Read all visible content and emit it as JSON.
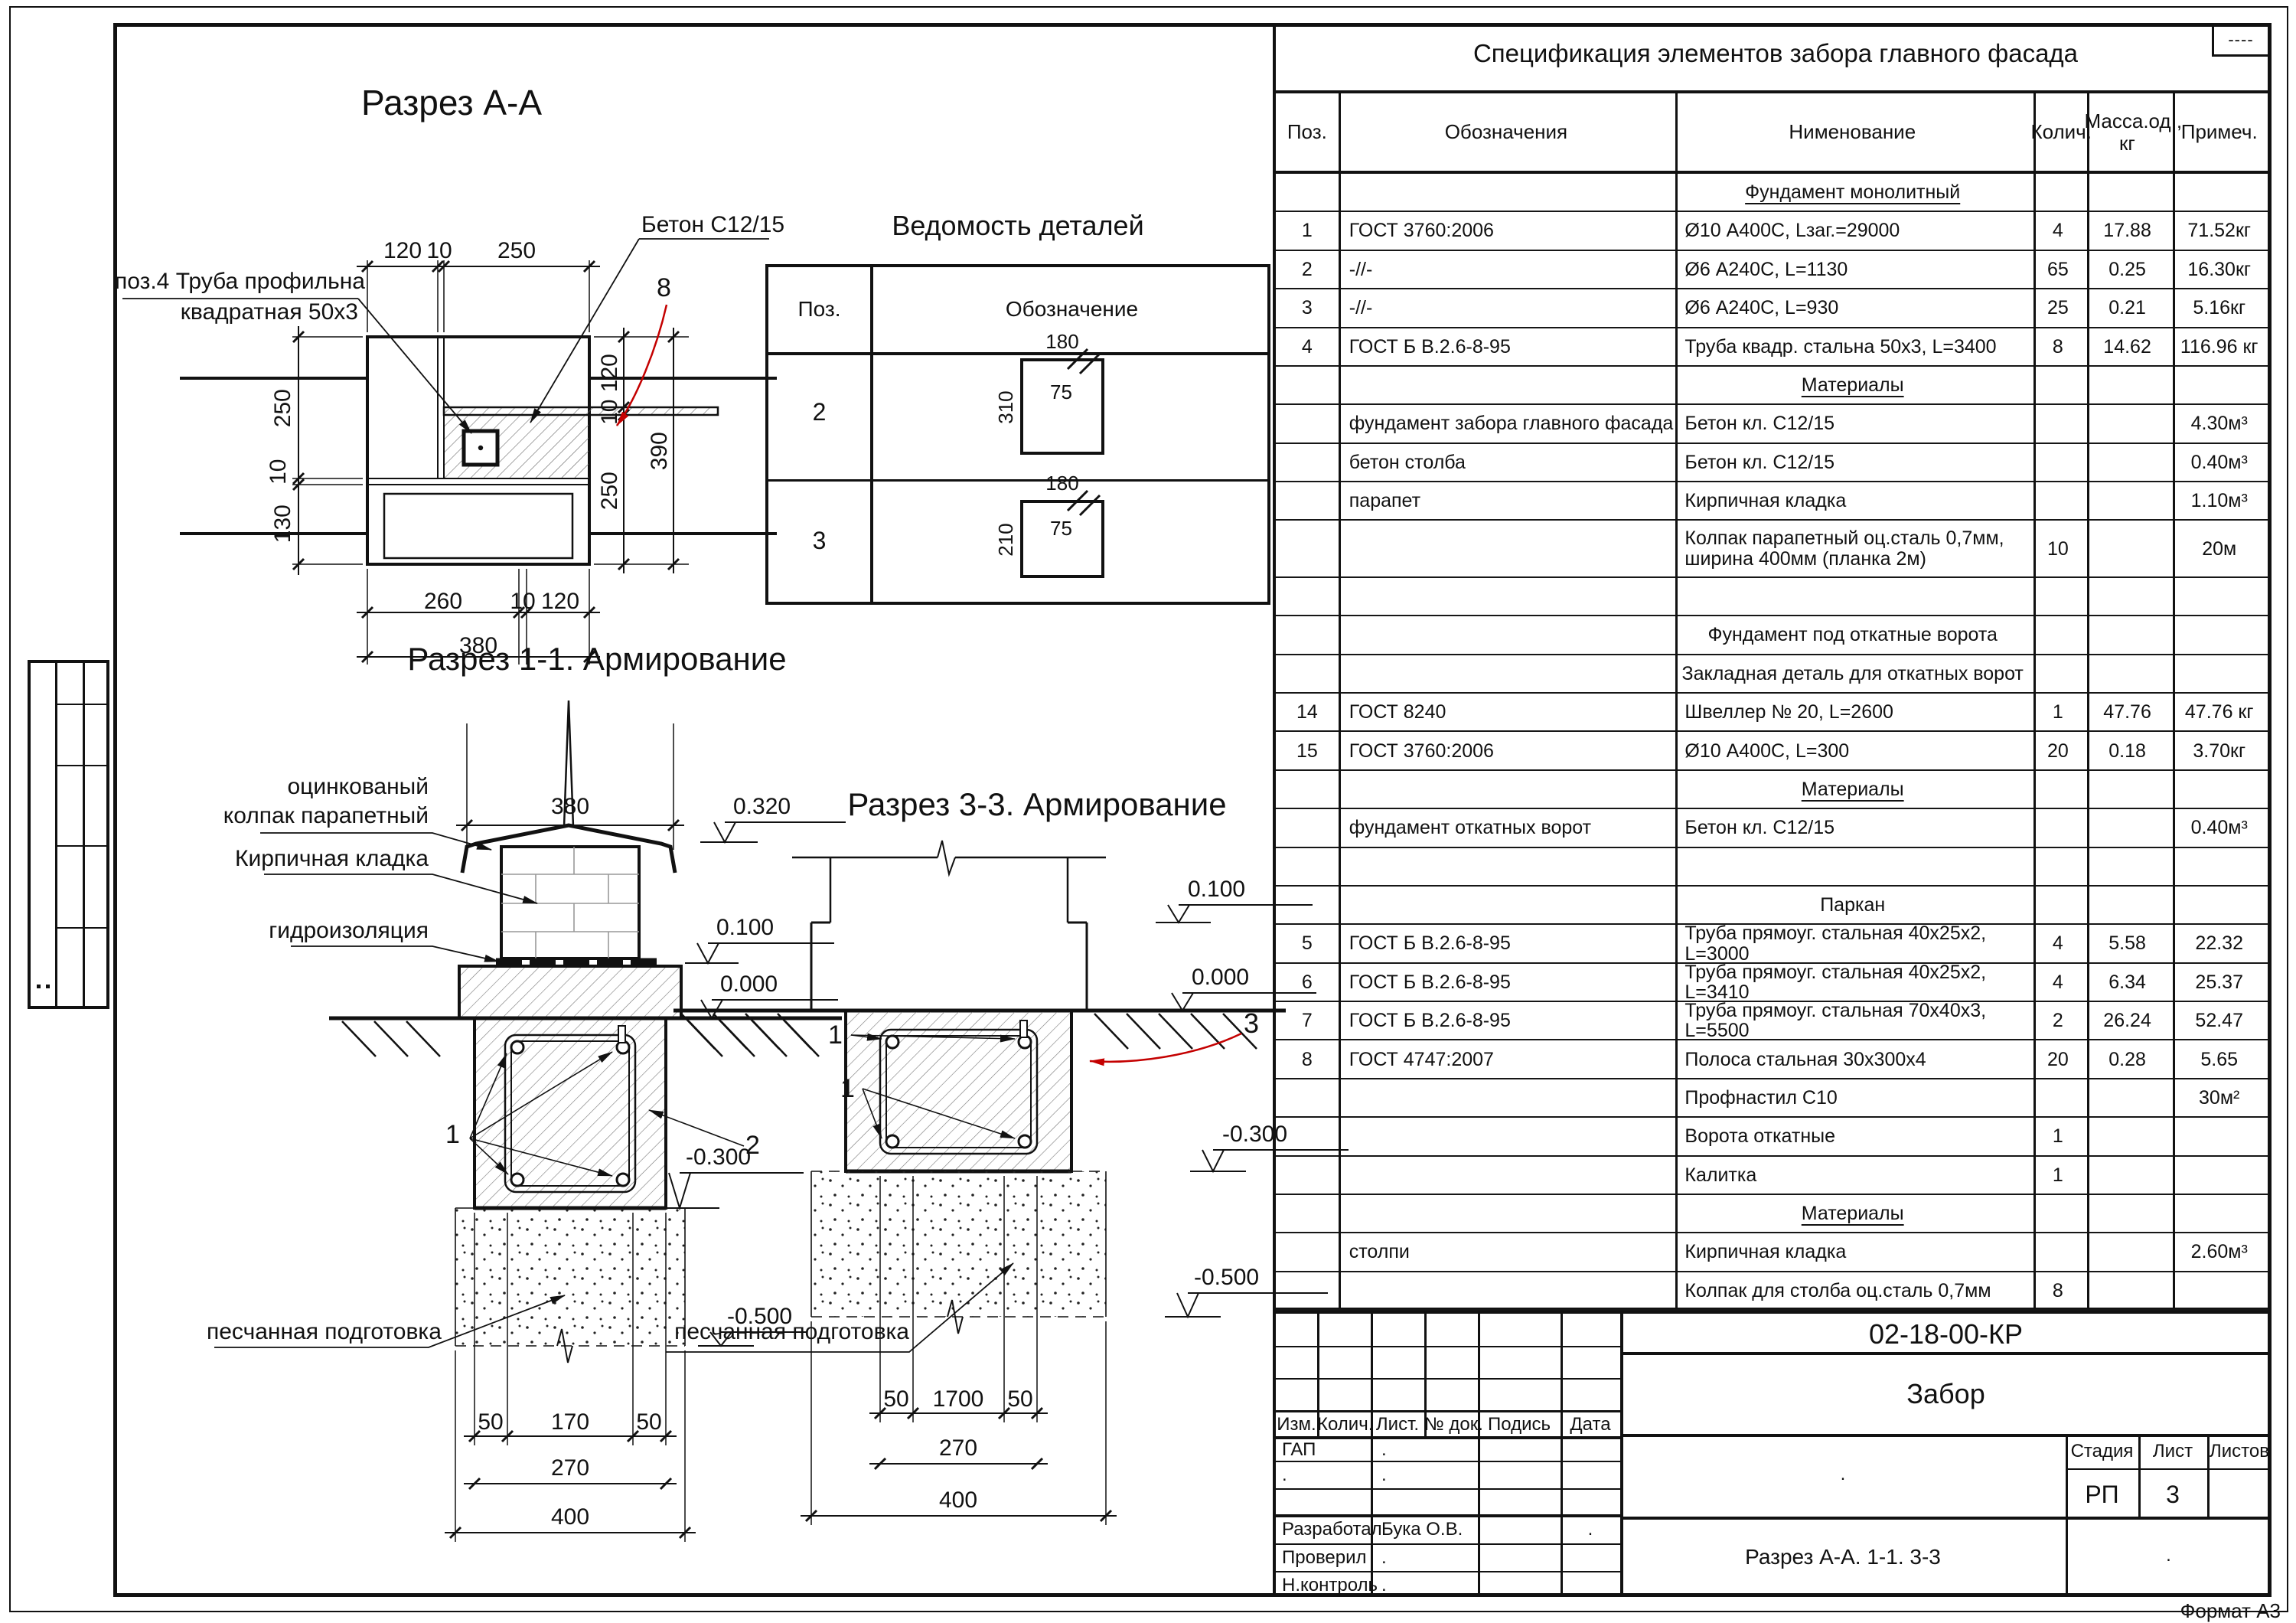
{
  "frame": {
    "format_label": "Формат А3",
    "corner_stamp": "----"
  },
  "titles": {
    "aa": "Разрез А-А",
    "details": "Ведомость деталей",
    "s11": "Разрез 1-1. Армирование",
    "s33": "Разрез 3-3. Армирование",
    "spec": "Спецификация элементов забора главного фасада"
  },
  "aa": {
    "pipe_label_1": "поз.4 Труба профильна",
    "pipe_label_2": "квадратная 50х3",
    "concrete_label": "Бетон С12/15",
    "callout_8": "8",
    "top": [
      "120",
      "10",
      "250"
    ],
    "left": [
      "250",
      "10",
      "130"
    ],
    "right": [
      "120",
      "10",
      "250",
      "390"
    ],
    "bottom": [
      "260",
      "10",
      "120",
      "380"
    ]
  },
  "s11": {
    "width_dim": "380",
    "levels": [
      "0.320",
      "0.100",
      "0.000",
      "-0.300",
      "-0.500"
    ],
    "labels": [
      "оцинкованый",
      "колпак парапетный",
      "Кирпичная кладка",
      "гидроизоляция",
      "песчанная подготовка"
    ],
    "callouts": [
      "1",
      "2"
    ],
    "dims": [
      "50",
      "170",
      "50",
      "270",
      "400"
    ]
  },
  "s33": {
    "levels": [
      "0.100",
      "0.000",
      "-0.300",
      "-0.500"
    ],
    "sand_label": "песчанная подготовка",
    "callouts": [
      "1",
      "1",
      "3"
    ],
    "dims": [
      "50",
      "1700",
      "50",
      "270",
      "400"
    ]
  },
  "details": {
    "col_pos": "Поз.",
    "col_designation": "Обозначение",
    "rows": [
      {
        "pos": "2",
        "w": "180",
        "h": "310",
        "t": "75"
      },
      {
        "pos": "3",
        "w": "180",
        "h": "210",
        "t": "75"
      }
    ]
  },
  "spec": {
    "headers": {
      "pos": "Поз.",
      "des": "Обозначения",
      "nam": "Нименование",
      "qty": "Колич.",
      "mass1": "Масса.од.,",
      "mass2": "кг",
      "note": "Примеч."
    },
    "rows": [
      {
        "type": "section",
        "nam": "Фундамент монолитный",
        "u": 1
      },
      {
        "pos": "1",
        "des": "ГОСТ 3760:2006",
        "nam": "Ø10 А400С, Lзаг.=29000",
        "qty": "4",
        "mass": "17.88",
        "note": "71.52кг"
      },
      {
        "pos": "2",
        "des": "-//-",
        "nam": "Ø6 А240С, L=1130",
        "qty": "65",
        "mass": "0.25",
        "note": "16.30кг"
      },
      {
        "pos": "3",
        "des": "-//-",
        "nam": "Ø6 А240С, L=930",
        "qty": "25",
        "mass": "0.21",
        "note": "5.16кг"
      },
      {
        "pos": "4",
        "des": "ГОСТ Б В.2.6-8-95",
        "nam": "Труба квадр. стальна 50х3, L=3400",
        "qty": "8",
        "mass": "14.62",
        "note": "116.96 кг"
      },
      {
        "type": "section",
        "nam": "Материалы",
        "u": 1
      },
      {
        "des": "фундамент забора главного фасада",
        "nam": "Бетон кл. С12/15",
        "note": "4.30м³"
      },
      {
        "des": "бетон столба",
        "nam": "Бетон кл. С12/15",
        "note": "0.40м³"
      },
      {
        "des": "парапет",
        "nam": "Кирпичная кладка",
        "note": "1.10м³"
      },
      {
        "big": 1,
        "nam": "Колпак парапетный оц.сталь 0,7мм, ширина 400мм (планка 2м)",
        "qty": "10",
        "note": "20м",
        "wrap": 1
      },
      {
        "type": "empty"
      },
      {
        "type": "section",
        "nam": "Фундамент под откатные ворота"
      },
      {
        "type": "section",
        "nam": "Закладная деталь для откатных ворот"
      },
      {
        "pos": "14",
        "des": "ГОСТ 8240",
        "nam": "Швеллер № 20, L=2600",
        "qty": "1",
        "mass": "47.76",
        "note": "47.76 кг"
      },
      {
        "pos": "15",
        "des": "ГОСТ 3760:2006",
        "nam": "Ø10 А400С, L=300",
        "qty": "20",
        "mass": "0.18",
        "note": "3.70кг"
      },
      {
        "type": "section",
        "nam": "Материалы",
        "u": 1
      },
      {
        "des": "фундамент откатных ворот",
        "nam": "Бетон кл. С12/15",
        "note": "0.40м³"
      },
      {
        "type": "empty"
      },
      {
        "type": "section",
        "nam": "Паркан"
      },
      {
        "pos": "5",
        "des": "ГОСТ Б В.2.6-8-95",
        "nam": "Труба прямоуг. стальная 40х25х2, L=3000",
        "qty": "4",
        "mass": "5.58",
        "note": "22.32"
      },
      {
        "pos": "6",
        "des": "ГОСТ Б В.2.6-8-95",
        "nam": "Труба прямоуг. стальная 40х25х2, L=3410",
        "qty": "4",
        "mass": "6.34",
        "note": "25.37"
      },
      {
        "pos": "7",
        "des": "ГОСТ Б В.2.6-8-95",
        "nam": "Труба прямоуг. стальная 70х40х3, L=5500",
        "qty": "2",
        "mass": "26.24",
        "note": "52.47"
      },
      {
        "pos": "8",
        "des": "ГОСТ 4747:2007",
        "nam": "Полоса стальная 30х300х4",
        "qty": "20",
        "mass": "0.28",
        "note": "5.65"
      },
      {
        "nam": "Профнастил С10",
        "note": "30м²"
      },
      {
        "nam": "Ворота откатные",
        "qty": "1"
      },
      {
        "nam": "Калитка",
        "qty": "1"
      },
      {
        "type": "section",
        "nam": "Материалы",
        "u": 1
      },
      {
        "des": "столпи",
        "nam": "Кирпичная кладка",
        "note": "2.60м³"
      },
      {
        "nam": "Колпак для столба оц.сталь 0,7мм",
        "qty": "8"
      }
    ]
  },
  "tb": {
    "doc": "02-18-00-КР",
    "object": "Забор",
    "drawing": "Разрез А-А. 1-1. 3-3",
    "stage_label": "Стадия",
    "sheet_label": "Лист",
    "sheets_label": "Листов",
    "stage": "РП",
    "sheet": "3",
    "cols": [
      "Изм.",
      "Колич.",
      "Лист.",
      "№ док.",
      "Подись",
      "Дата"
    ],
    "rows": [
      {
        "role": "ГАП",
        "val": "."
      },
      {
        "role": ".",
        "val": "."
      },
      {
        "role": "",
        "val": ""
      },
      {
        "role": "Разработал",
        "val": "Бука О.В.",
        "date": "."
      },
      {
        "role": "Проверил",
        "val": "."
      },
      {
        "role": "Н.контроль",
        "val": "."
      }
    ],
    "dot": "."
  }
}
